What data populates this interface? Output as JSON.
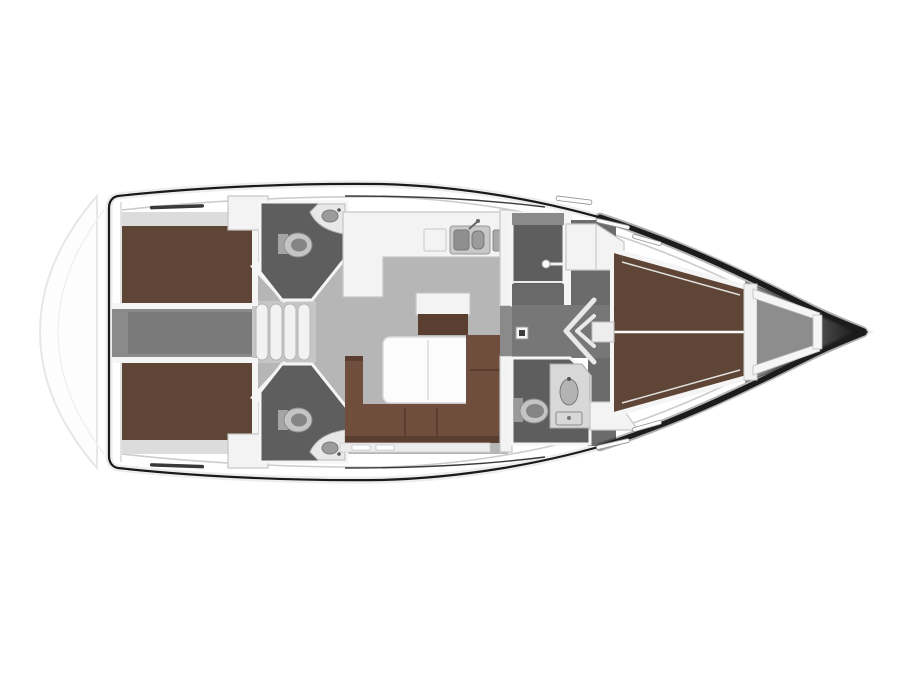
{
  "canvas": {
    "width": 900,
    "height": 675
  },
  "diagram": {
    "kind": "sailing-yacht-interior-floor-plan",
    "orientation": "bow-right-stern-left",
    "rooms": [
      {
        "name": "swim-platform",
        "colorKey": "platformLine"
      },
      {
        "name": "aft-cabin-port",
        "colorKey": "berthBrown"
      },
      {
        "name": "aft-cabin-starboard",
        "colorKey": "berthBrown"
      },
      {
        "name": "engine-compartment",
        "colorKey": "engineDark"
      },
      {
        "name": "companionway-steps",
        "colorKey": "stepTread"
      },
      {
        "name": "aft-head-port",
        "colorKey": "roomDark"
      },
      {
        "name": "aft-head-starboard",
        "colorKey": "roomDark"
      },
      {
        "name": "salon",
        "colorKey": "floorLight"
      },
      {
        "name": "galley",
        "colorKey": "furnitureWhite"
      },
      {
        "name": "shower-room",
        "colorKey": "roomDark"
      },
      {
        "name": "forward-corridor",
        "colorKey": "floorDark"
      },
      {
        "name": "forward-head",
        "colorKey": "roomDark"
      },
      {
        "name": "forward-cabin",
        "colorKey": "berthBrown"
      },
      {
        "name": "anchor-locker",
        "colorKey": "lockerFloor"
      },
      {
        "name": "bow-tip",
        "colorKey": "bowGradEnd"
      }
    ],
    "furniture": [
      {
        "name": "double-berth-aft-port"
      },
      {
        "name": "double-berth-aft-starboard"
      },
      {
        "name": "v-berth-forward"
      },
      {
        "name": "u-shaped-settee"
      },
      {
        "name": "folding-salon-table"
      },
      {
        "name": "sideboard-chart-table"
      },
      {
        "name": "galley-double-sink"
      },
      {
        "name": "toilet-aft-port"
      },
      {
        "name": "toilet-aft-starboard"
      },
      {
        "name": "toilet-forward"
      },
      {
        "name": "corner-washbasin-aft-port"
      },
      {
        "name": "corner-washbasin-aft-starboard"
      },
      {
        "name": "washbasin-forward"
      },
      {
        "name": "wardrobe-forward"
      },
      {
        "name": "companionway-steps-4"
      }
    ]
  },
  "colors": {
    "background": "#ffffff",
    "hullLine": "#1c1c1c",
    "deckLine": "#cccccc",
    "trunkLine": "#3a3a3a",
    "platformLine": "#e7e7e7",
    "floorLight": "#b6b6b6",
    "floorMid": "#8a8a8a",
    "floorDark": "#6b6b6b",
    "engineDark": "#7a7a7a",
    "roomDark": "#5e5e5e",
    "berthBrown": "#5f4536",
    "berthBrownDark": "#523a2e",
    "sofaBrown": "#6f4e3d",
    "sofaBrownDark": "#5a3f30",
    "furnitureWhite": "#f3f3f3",
    "furnitureStroke": "#c6c6c6",
    "shelfGray": "#dcdcdc",
    "stepTread": "#f2f2f2",
    "stepStroke": "#b5b5b5",
    "fixtureLight": "#c4c4c4",
    "fixtureMid": "#858585",
    "sinkBasin": "#9b9b9b",
    "lockerFloor": "#8d8d8d",
    "wallWhite": "#f5f5f5",
    "bowGradStart": "#909090",
    "bowGradEnd": "#0e0e0e"
  }
}
